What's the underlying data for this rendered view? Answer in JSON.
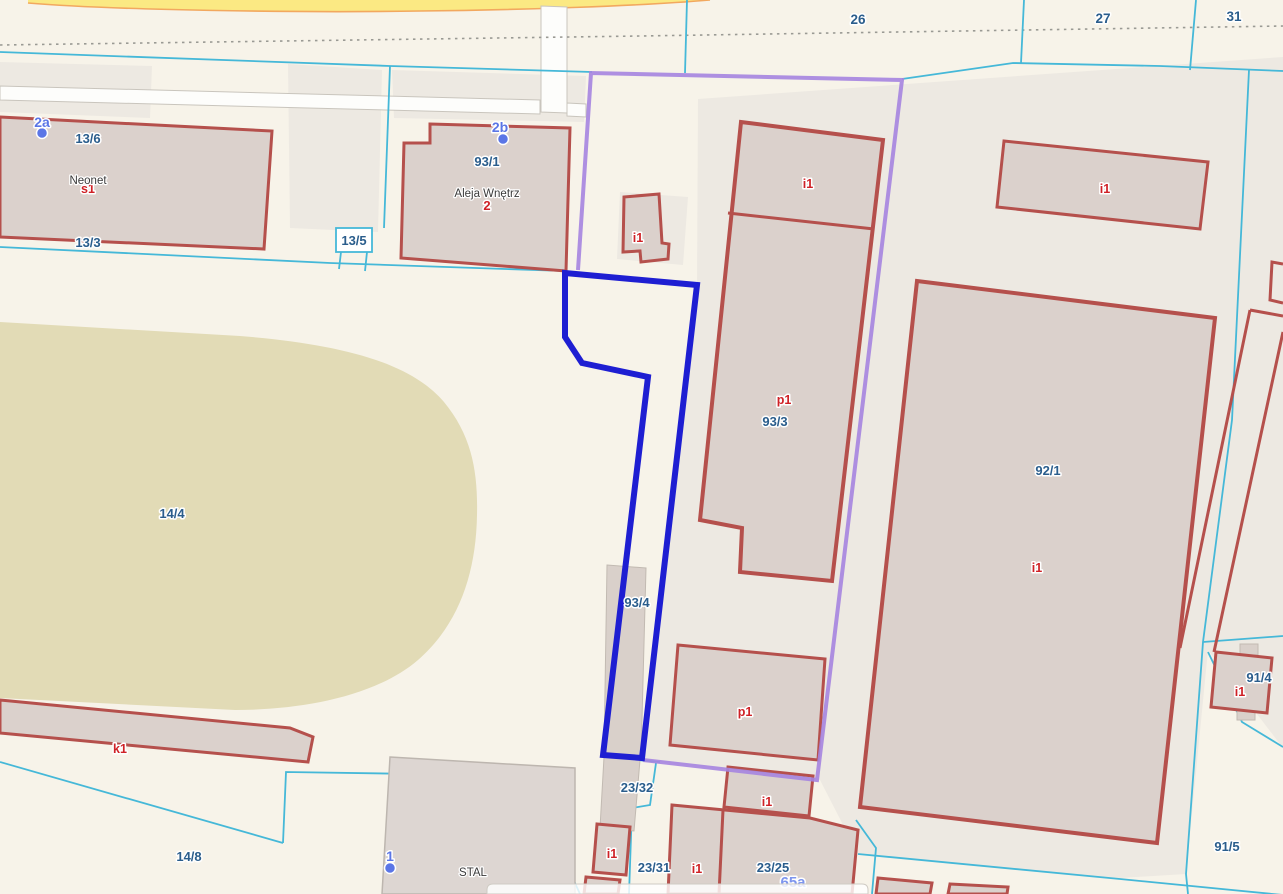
{
  "map": {
    "type": "cadastral-parcel-map",
    "selected_parcel": "93/4",
    "colors": {
      "background": "#F7F3E9",
      "parcel_pad": "#EDE9E2",
      "field_area": "#E2DBB6",
      "building_fill": "#DBD1CC",
      "building_outline": "#B5504C",
      "parcel_boundary": "#45B8D8",
      "selected_outline": "#1E1ED2",
      "highlight_outline": "#A584E0",
      "road_fill": "#FBE983",
      "road_edge": "#F2A85F",
      "parcel_label": "#2A5D8C",
      "building_label": "#CF2126",
      "marker_label": "#5B76E6",
      "address_label": "#7D95EE"
    },
    "labels": {
      "parcels": [
        {
          "text": "13/6"
        },
        {
          "text": "13/3"
        },
        {
          "text": "13/5"
        },
        {
          "text": "93/1"
        },
        {
          "text": "14/4"
        },
        {
          "text": "93/3"
        },
        {
          "text": "92/1"
        },
        {
          "text": "93/4"
        },
        {
          "text": "23/32"
        },
        {
          "text": "23/31"
        },
        {
          "text": "23/25"
        },
        {
          "text": "91/4"
        },
        {
          "text": "91/5"
        },
        {
          "text": "14/8"
        }
      ],
      "grid": [
        {
          "text": "26"
        },
        {
          "text": "27"
        },
        {
          "text": "31"
        }
      ],
      "building_codes": [
        {
          "text": "s1"
        },
        {
          "text": "i1"
        },
        {
          "text": "i1"
        },
        {
          "text": "i1"
        },
        {
          "text": "p1"
        },
        {
          "text": "i1"
        },
        {
          "text": "p1"
        },
        {
          "text": "k1"
        },
        {
          "text": "i1"
        },
        {
          "text": "i1"
        },
        {
          "text": "i1"
        },
        {
          "text": "i1"
        }
      ],
      "places": [
        {
          "text": "Neonet"
        },
        {
          "text": "Aleja Wnętrz"
        },
        {
          "text": "STAL"
        }
      ],
      "addresses": [
        {
          "text": "2"
        },
        {
          "text": "65a"
        }
      ],
      "markers": [
        {
          "text": "2a"
        },
        {
          "text": "2b"
        },
        {
          "text": "1"
        }
      ]
    }
  }
}
